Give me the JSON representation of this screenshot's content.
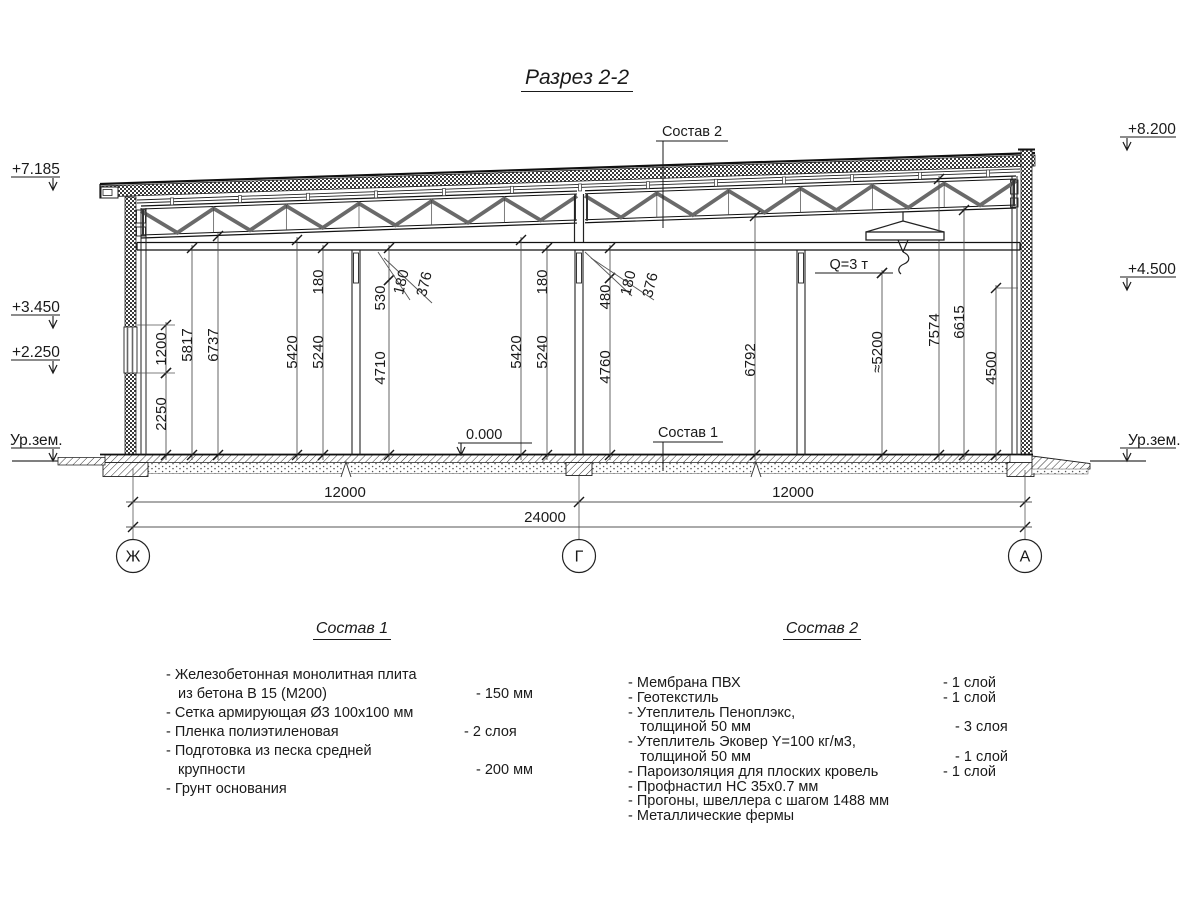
{
  "title": "Разрез 2-2",
  "labels": {
    "sostav2_callout": "Состав 2",
    "sostav1_callout": "Состав 1",
    "zero_level": "0.000",
    "crane_capacity": "Q=3 т"
  },
  "elevations": {
    "left": [
      "+7.185",
      "+3.450",
      "+2.250",
      "Ур.зем."
    ],
    "right": [
      "+8.200",
      "+4.500",
      "Ур.зем."
    ]
  },
  "axes": [
    "Ж",
    "Г",
    "А"
  ],
  "dims": {
    "vertical": [
      "1200",
      "2250",
      "5817",
      "6737",
      "5420",
      "5240",
      "180",
      "530",
      "4710",
      "180",
      "376",
      "5420",
      "5240",
      "180",
      "480",
      "4760",
      "180",
      "376",
      "6792",
      "≈5200",
      "7574",
      "6615",
      "4500"
    ],
    "horizontal": [
      "12000",
      "12000",
      "24000"
    ]
  },
  "sostav1": {
    "heading": "Состав 1",
    "lines": [
      {
        "t": "- Железобетонная  монолитная плита",
        "v": ""
      },
      {
        "t": "из бетона В 15 (М200)",
        "v": "- 150 мм"
      },
      {
        "t": "- Сетка армирующая Ø3 100x100 мм",
        "v": ""
      },
      {
        "t": "- Пленка полиэтиленовая",
        "v": "-  2 слоя"
      },
      {
        "t": "- Подготовка из песка средней",
        "v": ""
      },
      {
        "t": "крупности",
        "v": "- 200 мм"
      },
      {
        "t": "- Грунт основания",
        "v": ""
      }
    ]
  },
  "sostav2": {
    "heading": "Состав 2",
    "lines": [
      {
        "t": "- Мембрана ПВХ",
        "v": "- 1 слой"
      },
      {
        "t": "- Геотекстиль",
        "v": "- 1 слой"
      },
      {
        "t": "- Утеплитель Пеноплэкс,",
        "v": ""
      },
      {
        "t": "толщиной 50 мм",
        "v": "- 3 слоя"
      },
      {
        "t": "- Утеплитель Эковер Y=100 кг/м3,",
        "v": ""
      },
      {
        "t": "толщиной 50 мм",
        "v": "- 1 слой"
      },
      {
        "t": "- Пароизоляция для плоских кровель",
        "v": "- 1 слой"
      },
      {
        "t": "- Профнастил НС 35x0.7 мм",
        "v": ""
      },
      {
        "t": "- Прогоны, швеллера с шагом 1488 мм",
        "v": ""
      },
      {
        "t": "- Металлические фермы",
        "v": ""
      }
    ]
  },
  "colors": {
    "line": "#1a1a1a",
    "steel": "#6a6a6a",
    "background": "#ffffff"
  }
}
